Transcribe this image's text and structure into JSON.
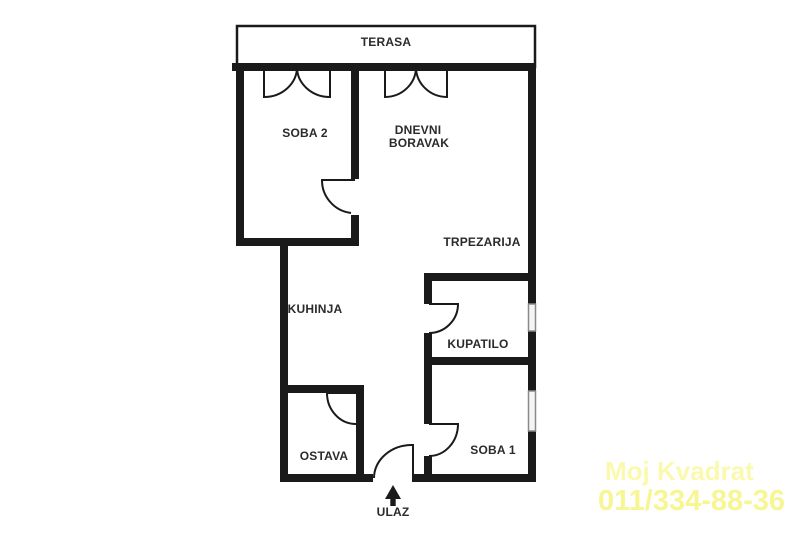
{
  "floor_plan": {
    "rooms": {
      "terasa": "TERASA",
      "soba2": "SOBA 2",
      "dnevni_line1": "DNEVNI",
      "dnevni_line2": "BORAVAK",
      "trpezarija": "TRPEZARIJA",
      "kuhinja": "KUHINJA",
      "kupatilo": "KUPATILO",
      "ostava": "OSTAVA",
      "soba1": "SOBA 1",
      "ulaz": "ULAZ"
    }
  },
  "watermark": {
    "line1": "Moj Kvadrat",
    "line2": "011/334-88-36"
  },
  "colors": {
    "wall": "#1a1a1a",
    "label": "#2b2b2b",
    "window_border": "#8a8a8a",
    "watermark_line1": "#fbf9ad",
    "watermark_line2": "#f8f593",
    "background": "#ffffff"
  }
}
